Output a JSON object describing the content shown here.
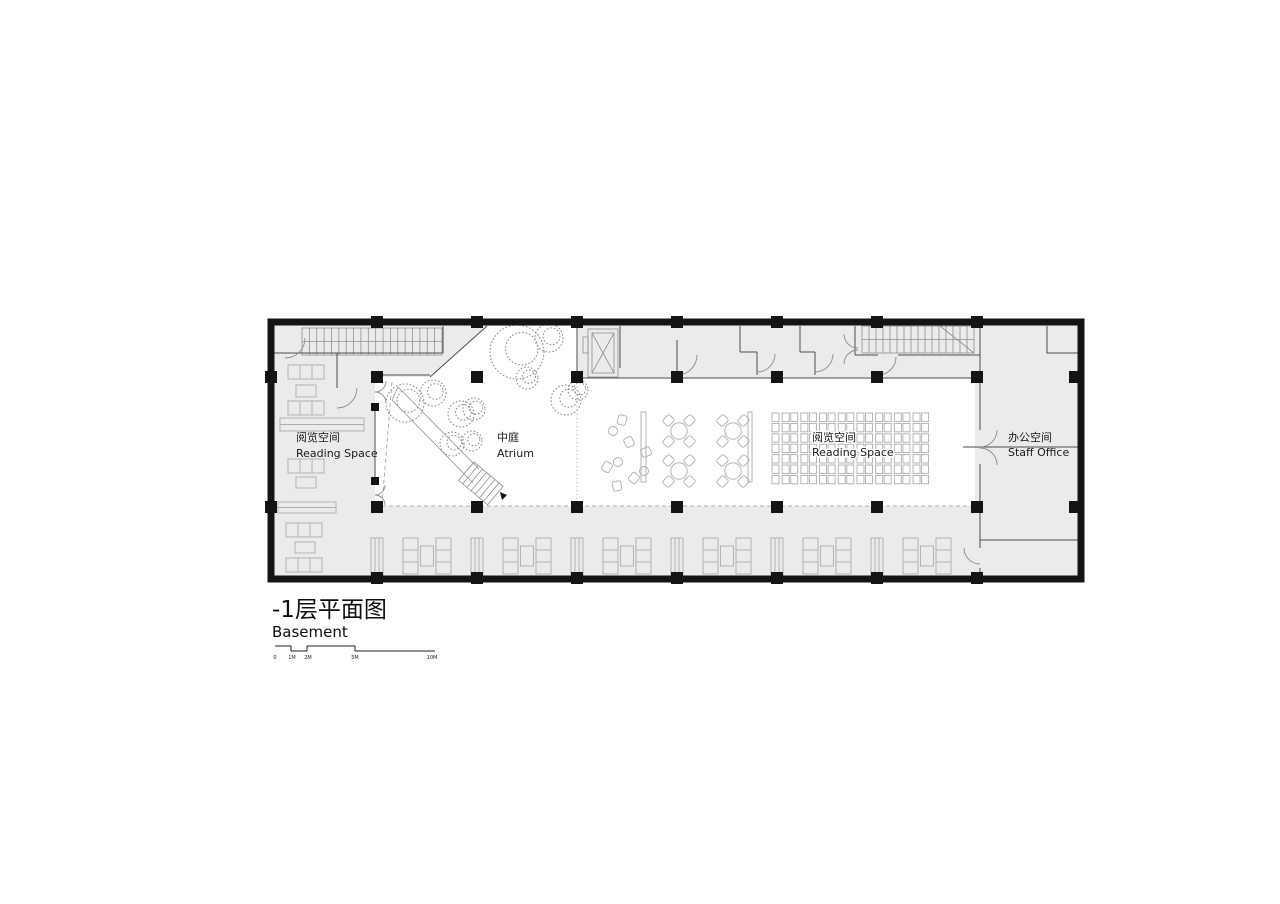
{
  "plan": {
    "title": {
      "zh": "-1层平面图",
      "en": "Basement"
    },
    "rooms": {
      "reading_left": {
        "zh": "阅览空间",
        "en": "Reading Space"
      },
      "atrium": {
        "zh": "中庭",
        "en": "Atrium"
      },
      "reading_center": {
        "zh": "阅览空间",
        "en": "Reading Space"
      },
      "staff_office": {
        "zh": "办公空间",
        "en": "Staff Office"
      }
    },
    "scale_bar": {
      "labels": [
        "0",
        "1M",
        "2M",
        "5M",
        "10M"
      ]
    },
    "colors": {
      "wall": "#141414",
      "floor": "#ebebeb",
      "atrium_floor": "#ffffff",
      "furniture_line": "#adadad"
    }
  }
}
